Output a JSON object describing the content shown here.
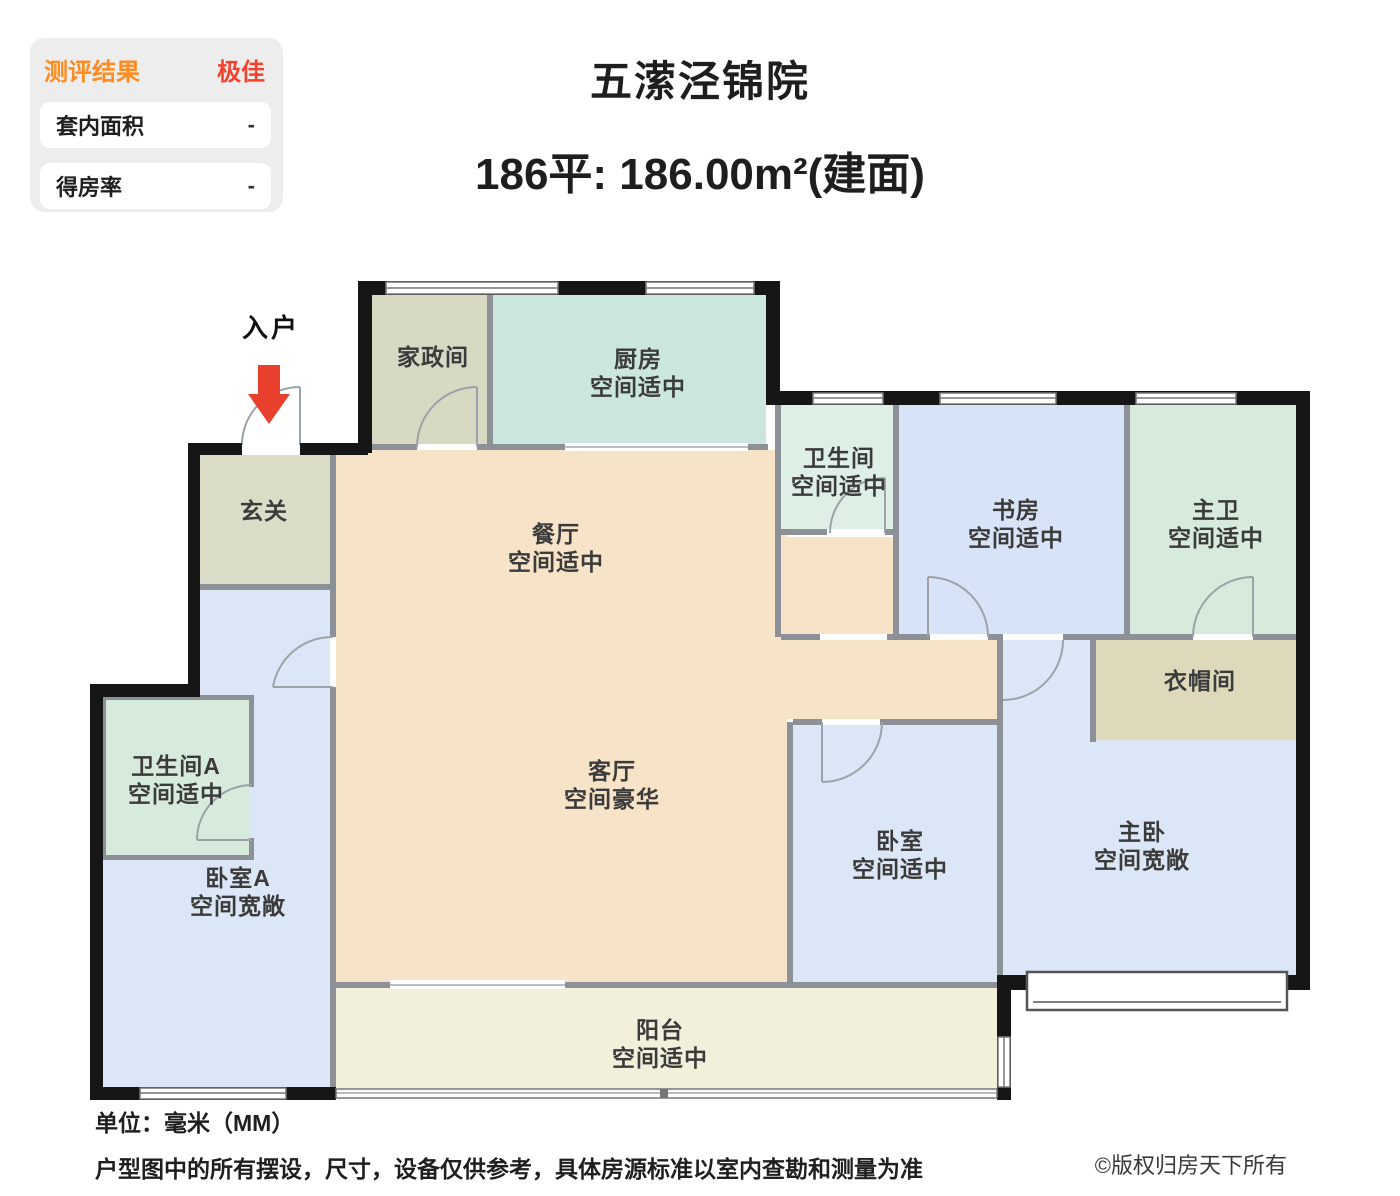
{
  "panel": {
    "title": "测评结果",
    "grade": "极佳",
    "rows": [
      {
        "label": "套内面积",
        "value": "-"
      },
      {
        "label": "得房率",
        "value": "-"
      }
    ]
  },
  "header": {
    "title": "五潆泾锦院",
    "area_line": "186平: 186.00m²(建面)"
  },
  "plan": {
    "entrance_label": "入户",
    "entrance_arrow_icon": "red-down-arrow"
  },
  "rooms": [
    {
      "name": "家政间"
    },
    {
      "name": "厨房",
      "grade": "空间适中"
    },
    {
      "name": "玄关"
    },
    {
      "name": "餐厅",
      "grade": "空间适中"
    },
    {
      "name": "卫生间",
      "grade": "空间适中"
    },
    {
      "name": "书房",
      "grade": "空间适中"
    },
    {
      "name": "主卫",
      "grade": "空间适中"
    },
    {
      "name": "衣帽间"
    },
    {
      "name": "卫生间A",
      "grade": "空间适中"
    },
    {
      "name": "卧室A",
      "grade": "空间宽敞"
    },
    {
      "name": "客厅",
      "grade": "空间豪华"
    },
    {
      "name": "卧室",
      "grade": "空间适中"
    },
    {
      "name": "主卧",
      "grade": "空间宽敞"
    },
    {
      "name": "阳台",
      "grade": "空间适中"
    }
  ],
  "footer": {
    "unit": "单位：毫米（MM）",
    "disclaimer": "户型图中的所有摆设，尺寸，设备仅供参考，具体房源标准以室内查勘和测量为准",
    "copyright": "©版权归房天下所有"
  },
  "colors": {
    "accent_orange": "#ff8a1e",
    "accent_red": "#f2422f",
    "arrow_red": "#e8402d",
    "wall_black": "#161616",
    "wall_gray": "#8b9196",
    "room_peach": "#f7e3c7",
    "room_mint": "#cbe7dd",
    "room_mint_pale": "#def0e6",
    "room_green": "#d6ebdb",
    "room_blue": "#dbe6f7",
    "room_blue_study": "#d7e3f6",
    "room_sage": "#d8d9c3",
    "room_tan": "#ded9bb",
    "room_cream": "#f2efdb"
  }
}
